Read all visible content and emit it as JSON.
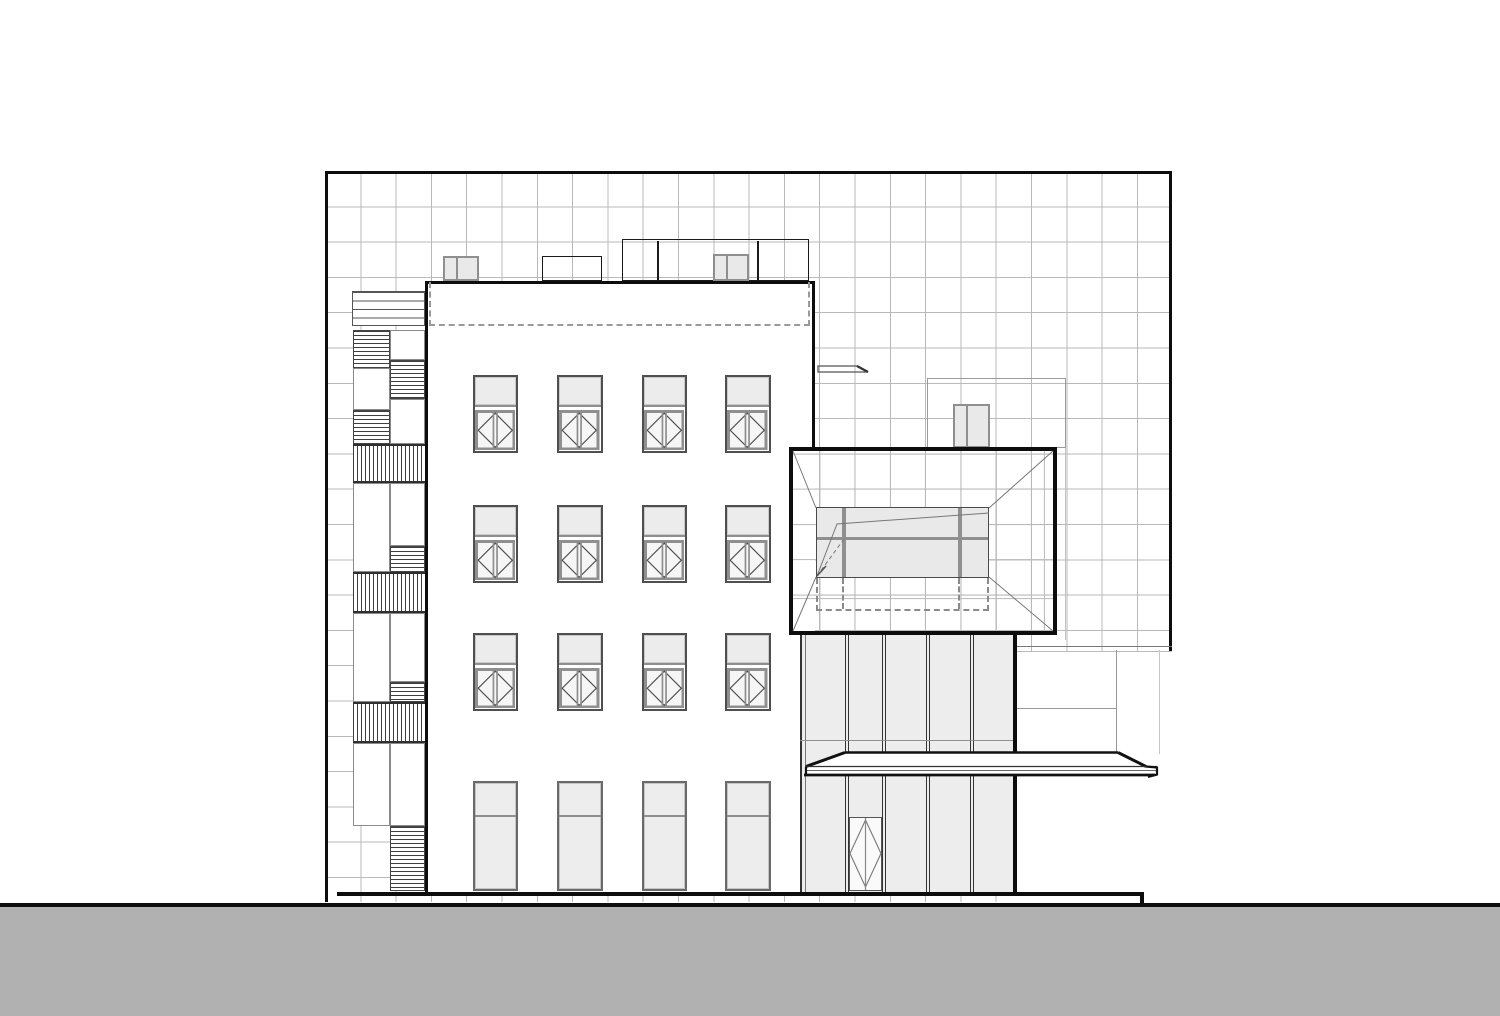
{
  "title": "building-elevation-drawing",
  "canvas": {
    "w": 1500,
    "h": 1016,
    "bg": "#ffffff"
  },
  "colors": {
    "ink": "#0d0d0d",
    "grid_line": "#b9b9b9",
    "thin_line": "#555555",
    "hatch": "#3f3f3f",
    "frame_gray": "#8f8f8f",
    "window_dark": "#4f4f4f",
    "spandrel": "#ececec",
    "glass": "#f6f6f6",
    "panel_glass": "#ededed",
    "inner_glass": "#e9e9e9",
    "ground_gray": "#b1b1b1",
    "dash_gray": "#9a9a9a"
  },
  "grid_wall": {
    "x": 325,
    "y": 171,
    "w": 847,
    "h": 731,
    "cell": 35.3,
    "borders": [
      {
        "name": "grid-border-top",
        "x": 325,
        "y": 171,
        "w": 847,
        "h": 3
      },
      {
        "name": "grid-border-left",
        "x": 325,
        "y": 171,
        "w": 3,
        "h": 731
      },
      {
        "name": "grid-border-right",
        "x": 1169,
        "y": 171,
        "w": 3,
        "h": 608
      }
    ]
  },
  "roof_terrace_outline": {
    "x": 926.5,
    "y": 378,
    "w": 139,
    "h": 70,
    "tail": {
      "x": 1064.5,
      "y": 448,
      "w": 1,
      "h": 192
    }
  },
  "rooftop_boxes": [
    {
      "name": "rooftop-vent-box-left",
      "x": 442.5,
      "y": 256,
      "w": 36,
      "h": 25,
      "fill": "#e9e9e9",
      "gray": true,
      "dividers": [
        456
      ]
    },
    {
      "name": "rooftop-box-small",
      "x": 541.5,
      "y": 256,
      "w": 60,
      "h": 25,
      "gray": false,
      "dividers": []
    },
    {
      "name": "rooftop-penthouse-box",
      "x": 621.5,
      "y": 239,
      "w": 187,
      "h": 42,
      "gray": false,
      "dividers": [
        657,
        757
      ]
    },
    {
      "name": "rooftop-vent-box-right",
      "x": 712.5,
      "y": 254,
      "w": 36,
      "h": 27,
      "fill": "#e9e9e9",
      "gray": true,
      "dividers": [
        726
      ]
    }
  ],
  "chimney": {
    "x": 952.5,
    "y": 404,
    "w": 37,
    "h": 44,
    "fill": "#e9e9e9",
    "dividers": [
      966
    ]
  },
  "left_strip": {
    "blocks": [
      {
        "type": "louver",
        "x": 352,
        "y": 291,
        "w": 73,
        "h": 35
      },
      {
        "type": "hstair",
        "x": 352.5,
        "y": 330,
        "w": 37.5,
        "h": 38
      },
      {
        "type": "panel",
        "x": 390,
        "y": 330,
        "w": 35,
        "h": 30
      },
      {
        "type": "hstair",
        "x": 389.5,
        "y": 360,
        "w": 35.5,
        "h": 39
      },
      {
        "type": "panel",
        "x": 352.5,
        "y": 368,
        "w": 37.5,
        "h": 42
      },
      {
        "type": "hstair",
        "x": 352.5,
        "y": 410,
        "w": 37.5,
        "h": 34
      },
      {
        "type": "panel",
        "x": 390,
        "y": 399,
        "w": 35,
        "h": 45
      },
      {
        "type": "vrail",
        "x": 352.5,
        "y": 444,
        "w": 72.5,
        "h": 39
      },
      {
        "type": "panel",
        "x": 352.5,
        "y": 483,
        "w": 37.5,
        "h": 89
      },
      {
        "type": "panel",
        "x": 390,
        "y": 483,
        "w": 35,
        "h": 63
      },
      {
        "type": "hstair",
        "x": 389.5,
        "y": 546,
        "w": 35.5,
        "h": 26
      },
      {
        "type": "vrail",
        "x": 352.5,
        "y": 572,
        "w": 72.5,
        "h": 41
      },
      {
        "type": "panel",
        "x": 352.5,
        "y": 613,
        "w": 37.5,
        "h": 89
      },
      {
        "type": "panel",
        "x": 390,
        "y": 613,
        "w": 35,
        "h": 69
      },
      {
        "type": "hstair",
        "x": 389.5,
        "y": 682,
        "w": 35.5,
        "h": 20
      },
      {
        "type": "vrail",
        "x": 352.5,
        "y": 702,
        "w": 72.5,
        "h": 41
      },
      {
        "type": "panel",
        "x": 352.5,
        "y": 743,
        "w": 37.5,
        "h": 83
      },
      {
        "type": "panel",
        "x": 390,
        "y": 743,
        "w": 35,
        "h": 83
      },
      {
        "type": "hstair",
        "x": 389.5,
        "y": 826,
        "w": 35.5,
        "h": 65
      }
    ]
  },
  "facade": {
    "x": 425,
    "y": 281,
    "w": 390,
    "h": 612,
    "borders": [
      {
        "name": "facade-border-top",
        "x": 425,
        "y": 281,
        "w": 390,
        "h": 3.4
      },
      {
        "name": "facade-border-left",
        "x": 425,
        "y": 281,
        "w": 3.4,
        "h": 612
      },
      {
        "name": "facade-border-right",
        "x": 811.6,
        "y": 281,
        "w": 3.4,
        "h": 170
      }
    ],
    "dashed_parapet": {
      "x": 429,
      "y": 282,
      "w": 381,
      "h": 44
    }
  },
  "windows": {
    "cols": [
      472.5,
      557,
      641.5,
      725
    ],
    "w": 45.5,
    "rows": [
      375,
      505,
      633
    ],
    "h": 78,
    "spandrel_h": 30,
    "tall": {
      "y": 781,
      "h": 110,
      "transom_dy": 32
    }
  },
  "frame_box": {
    "x": 789,
    "y": 447,
    "w": 268,
    "h": 188,
    "border_w": 4,
    "grid_offset_x": -9.1,
    "grid_offset_y": -32.9,
    "inner": {
      "x": 816,
      "y": 507,
      "w": 173,
      "h": 71,
      "mullions": [
        841.5,
        957.5
      ],
      "mullion_w": 4,
      "band_y": 536.5,
      "band_h": 3.5
    },
    "dashed": {
      "x": 816,
      "y": 578,
      "w": 173,
      "h": 33,
      "verts": [
        841.5,
        957.5
      ]
    },
    "lines": [
      {
        "d": "M793,451 L816,508",
        "w": 1,
        "c": "#777"
      },
      {
        "d": "M1053,451 L989,508",
        "w": 1,
        "c": "#777"
      },
      {
        "d": "M793,631 L816,577",
        "w": 1,
        "c": "#777"
      },
      {
        "d": "M1053,631 L989,577",
        "w": 1,
        "c": "#777"
      },
      {
        "d": "M817,576 L837,524 L989,513",
        "w": 1,
        "c": "#777"
      },
      {
        "d": "M817,576 L844,539",
        "w": 1,
        "c": "#777",
        "dash": "4 3"
      },
      {
        "d": "M817,576 L826,566",
        "w": 1.6,
        "c": "#555"
      }
    ]
  },
  "glazing": {
    "x": 800,
    "y": 635,
    "w": 217,
    "h": 258,
    "left_lines": [
      {
        "x": 800,
        "w": 1.6,
        "c": "#333"
      },
      {
        "x": 804.5,
        "w": 1,
        "c": "#777"
      }
    ],
    "mullions": [
      846.5,
      884,
      928,
      971.5
    ],
    "mullion_w": 4,
    "transom_y": 740,
    "right_bar": {
      "x": 1012.5,
      "w": 4.5
    }
  },
  "door": {
    "x": 848.5,
    "y": 817,
    "w": 33.5,
    "h": 74,
    "paths": [
      {
        "d": "M865.5,820 L881,853.5 L865.5,887 L850,853.5 Z",
        "w": 1.1,
        "c": "#777"
      },
      {
        "d": "M865.5,818 L865.5,890",
        "w": 1.2,
        "c": "#888"
      }
    ]
  },
  "right_room": {
    "x": 1017,
    "y": 651,
    "w": 155,
    "h": 254,
    "lines": [
      {
        "o": "h",
        "y": 645.5,
        "x1": 1017,
        "x2": 1172,
        "c": "#777",
        "w": 1.2
      },
      {
        "o": "h",
        "y": 650.5,
        "x1": 1017,
        "x2": 1172,
        "c": "#bbbbbb",
        "w": 1
      },
      {
        "o": "h",
        "y": 708,
        "x1": 1017,
        "x2": 1116,
        "c": "#999999",
        "w": 1
      },
      {
        "o": "v",
        "x": 1116,
        "y1": 650,
        "y2": 754,
        "c": "#999999",
        "w": 1
      },
      {
        "o": "v",
        "x": 1159,
        "y1": 650,
        "y2": 754,
        "c": "#c6c6c6",
        "w": 1
      }
    ]
  },
  "canopy": {
    "fill_path": "M845,752.5 L1118,752.5 L1146,766.5 L1157,767.5 L1157,774.5 L806,774.5 L806,766.5 Z",
    "strokes": [
      {
        "d": "M845,752.5 L1118,752.5",
        "w": 2.6,
        "c": "#111"
      },
      {
        "d": "M845,752.5 L806,766.5",
        "w": 3,
        "c": "#111"
      },
      {
        "d": "M1118,752.5 L1146,766.5",
        "w": 3,
        "c": "#111"
      },
      {
        "d": "M806,766.5 L1157,766.5",
        "w": 1.2,
        "c": "#333"
      },
      {
        "d": "M806,770.5 L1157,770.5",
        "w": 1,
        "c": "#666"
      },
      {
        "d": "M804,775 L1155,775",
        "w": 2.8,
        "c": "#111"
      },
      {
        "d": "M1146,766.5 L1157,767.5 L1157,774.5 L1148,777",
        "w": 2.2,
        "c": "#111"
      },
      {
        "d": "M806,766.5 L806,775",
        "w": 2.2,
        "c": "#111"
      }
    ]
  },
  "fin": {
    "paths": [
      {
        "d": "M818,366 L857,366 L868,372 L818,372 Z",
        "w": 1.3,
        "c": "#555"
      },
      {
        "d": "M857,366 L868,372",
        "w": 2.2,
        "c": "#333"
      }
    ]
  },
  "ground": {
    "plinth": {
      "x": 337,
      "y": 892.3,
      "w": 806,
      "h": 4.2
    },
    "step": {
      "x": 1139.5,
      "y": 892.3,
      "w": 4,
      "h": 11.5
    },
    "line": {
      "x": 0,
      "y": 902.5,
      "w": 1500,
      "h": 4.4
    },
    "fill": {
      "x": 0,
      "y": 906.9,
      "w": 1500,
      "h": 109.1
    }
  }
}
